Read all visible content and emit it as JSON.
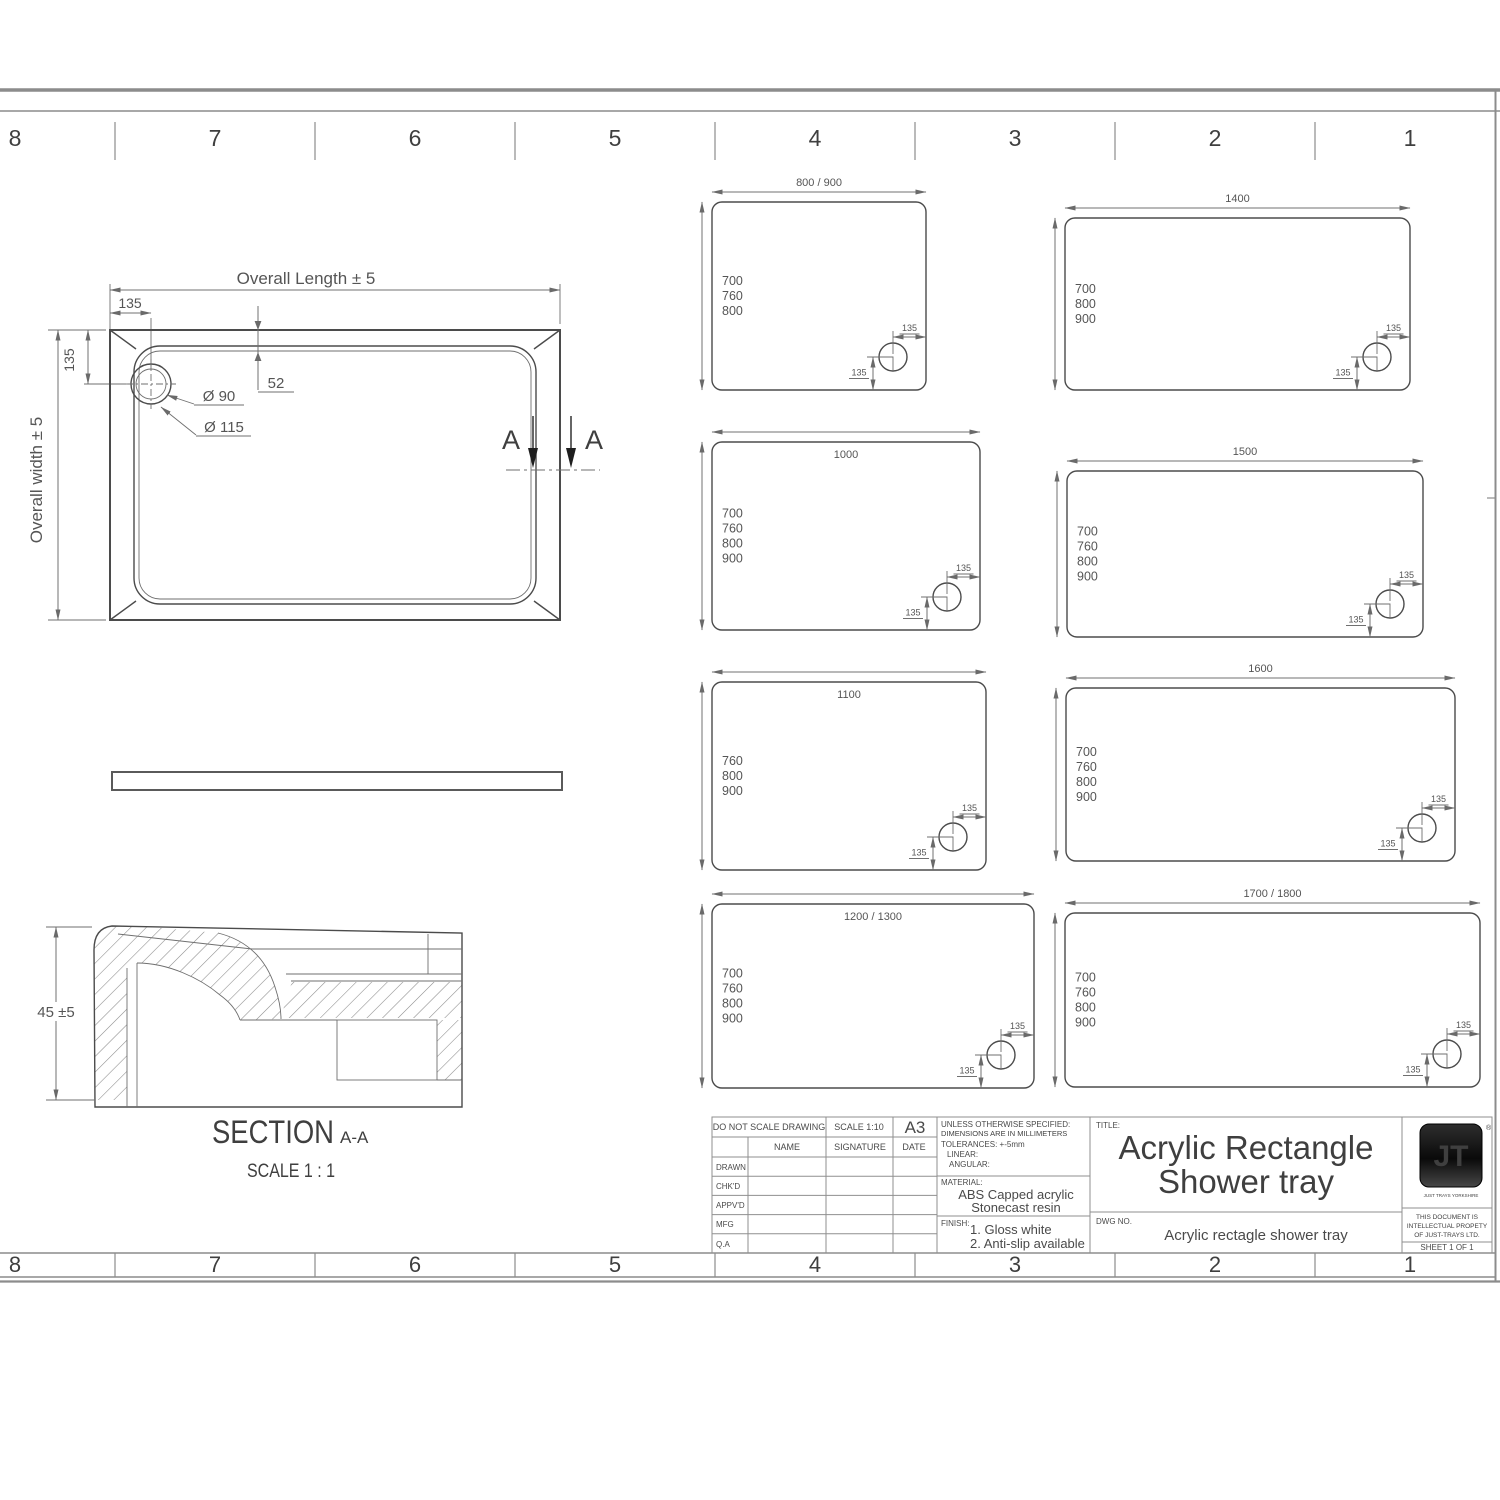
{
  "sheet": {
    "zones": [
      "8",
      "7",
      "6",
      "5",
      "4",
      "3",
      "2",
      "1"
    ]
  },
  "colors": {
    "line": "#4b4b4b",
    "dim_line": "#707070",
    "text": "#3f3f3f",
    "frame": "#8c8c8c",
    "logo_bg": "#111111"
  },
  "plan_view": {
    "overall_length_label": "Overall Length ± 5",
    "overall_width_label": "Overall width ± 5",
    "drain_offset_x": "135",
    "drain_offset_y": "135",
    "rim_height": "52",
    "waste_inner_dia": "Ø 90",
    "waste_outer_dia": "Ø 115",
    "section_letter_left": "A",
    "section_letter_right": "A"
  },
  "section_view": {
    "height_dim": "45 ±5",
    "title": "SECTION",
    "title_suffix": "A-A",
    "scale_note": "SCALE 1 : 1"
  },
  "tray_sizes": [
    {
      "length": "800 / 900",
      "widths": [
        "700",
        "760",
        "800"
      ],
      "drain_offset_x": "135",
      "drain_offset_y": "135"
    },
    {
      "length": "1000",
      "widths": [
        "700",
        "760",
        "800",
        "900"
      ],
      "drain_offset_x": "135",
      "drain_offset_y": "135"
    },
    {
      "length": "1100",
      "widths": [
        "760",
        "800",
        "900"
      ],
      "drain_offset_x": "135",
      "drain_offset_y": "135"
    },
    {
      "length": "1200 / 1300",
      "widths": [
        "700",
        "760",
        "800",
        "900"
      ],
      "drain_offset_x": "135",
      "drain_offset_y": "135"
    },
    {
      "length": "1400",
      "widths": [
        "700",
        "800",
        "900"
      ],
      "drain_offset_x": "135",
      "drain_offset_y": "135"
    },
    {
      "length": "1500",
      "widths": [
        "700",
        "760",
        "800",
        "900"
      ],
      "drain_offset_x": "135",
      "drain_offset_y": "135"
    },
    {
      "length": "1600",
      "widths": [
        "700",
        "760",
        "800",
        "900"
      ],
      "drain_offset_x": "135",
      "drain_offset_y": "135"
    },
    {
      "length": "1700 / 1800",
      "widths": [
        "700",
        "760",
        "800",
        "900"
      ],
      "drain_offset_x": "135",
      "drain_offset_y": "135"
    }
  ],
  "title_block": {
    "do_not_scale": "DO NOT SCALE DRAWING",
    "scale": "SCALE 1:10",
    "paper": "A3",
    "name": "NAME",
    "signature": "SIGNATURE",
    "date": "DATE",
    "rows": [
      "DRAWN",
      "CHK'D",
      "APPV'D",
      "MFG",
      "Q.A"
    ],
    "spec_line1": "UNLESS OTHERWISE SPECIFIED:",
    "spec_line2": "DIMENSIONS ARE IN MILLIMETERS",
    "spec_line3": "TOLERANCES: +-5mm",
    "spec_line4": "LINEAR:",
    "spec_line5": "ANGULAR:",
    "material_label": "MATERIAL:",
    "material_line1": "ABS Capped acrylic",
    "material_line2": "Stonecast resin",
    "finish_label": "FINISH:",
    "finish_line1": "1. Gloss white",
    "finish_line2": "2. Anti-slip available",
    "title_label": "TITLE:",
    "title_line1": "Acrylic Rectangle",
    "title_line2": "Shower tray",
    "dwg_label": "DWG NO.",
    "dwg_value": "Acrylic rectagle shower tray",
    "logo_text": "JT",
    "logo_reg": "®",
    "logo_tagline": "JUST TRAYS YORKSHIRE",
    "property_line1": "THIS DOCUMENT IS",
    "property_line2": "INTELLECTUAL PROPETY",
    "property_line3": "OF JUST-TRAYS LTD.",
    "sheet_label": "SHEET 1 OF 1"
  }
}
